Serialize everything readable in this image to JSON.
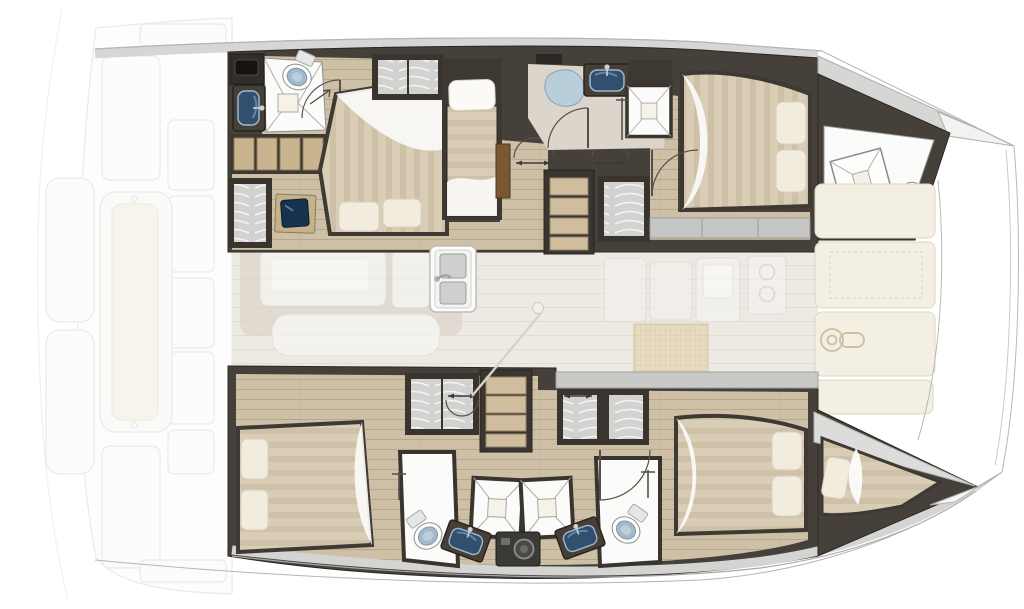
{
  "meta": {
    "title": "Catamaran yacht interior floor plan — top view, bow pointing right",
    "diagram_type": "floor-plan",
    "orientation": {
      "bow": "right",
      "stern": "left"
    }
  },
  "colors": {
    "background": "#ffffff",
    "wall_dark": "#46403a",
    "wall_edge": "#2b2723",
    "deck_band": "#d5d5d3",
    "wood_floor": "#cec0a6",
    "wood_line": "#b8a88b",
    "salon_floor": "#edeae3",
    "bath_floor": "#fbfbf9",
    "bath_floor_warm": "#dbd5cc",
    "mattress": "#d9cdb6",
    "mattress_stripe": "#cec1a7",
    "pillow": "#f2ecdf",
    "blanket": "#fcfbf8",
    "sink_basin": "#31506e",
    "sink_rim": "#9db7ca",
    "toilet_seat": "#a3b9cb",
    "shower_glass": "#b9cedb",
    "locker_fill": "#d2d2d0",
    "locker_wave": "#f4f4f2",
    "stair_tread": "#cfbd9d",
    "ghost_line": "#dddddb",
    "ghost_fill": "#fafaf8",
    "cushion_cream": "#f3ecdf",
    "foredeck_panel": "#f4efe3",
    "rattan": "#e8dabb",
    "washer_body": "#3b3a37",
    "door_wood": "#7a5836",
    "screen_navy": "#16324c"
  },
  "areas": [
    {
      "id": "aft-deck",
      "label": "Aft deck, cockpit seat and swim platforms (faded)"
    },
    {
      "id": "hull-structure",
      "label": "Catamaran hull outline, bow pointing right"
    },
    {
      "id": "port-aft-bathroom",
      "label": "Port aft bathroom with toilet, shower and sink"
    },
    {
      "id": "port-aft-cabin",
      "label": "Port aft cabin with island double bed, desk, shelves and wardrobe"
    },
    {
      "id": "port-single-berth",
      "label": "Port midship single berth"
    },
    {
      "id": "port-companionway",
      "label": "Port companionway stairs with wardrobe and door"
    },
    {
      "id": "port-mid-bathroom",
      "label": "Port midship bathroom with shower pod, shower stall and sink"
    },
    {
      "id": "port-forward-cabin",
      "label": "Port forward cabin with double bed"
    },
    {
      "id": "port-forepeak",
      "label": "Port forepeak with deck hatch and toilet"
    },
    {
      "id": "salon",
      "label": "Bridgedeck salon with table and seating (faded)"
    },
    {
      "id": "galley",
      "label": "Galley with double sink, cabinets, stove and rattan mat"
    },
    {
      "id": "foredeck",
      "label": "Foredeck sun cushions with anchor windlass"
    },
    {
      "id": "starboard-aft-cabin",
      "label": "Starboard aft cabin with double bed"
    },
    {
      "id": "starboard-companionway",
      "label": "Starboard companionway stairs with wardrobes"
    },
    {
      "id": "starboard-bathroom",
      "label": "Starboard shared bathroom: two showers, two sinks, two toilets, washer"
    },
    {
      "id": "starboard-forward-cabin",
      "label": "Starboard forward cabin with double bed"
    },
    {
      "id": "starboard-bow-berth",
      "label": "Starboard bow berth"
    }
  ],
  "fixtures": {
    "double_beds": 4,
    "single_berths": 2,
    "toilets": 4,
    "bathroom_sinks": 4,
    "galley_sinks": 1,
    "shower_stalls": 4,
    "shower_pods": 1,
    "wardrobes": 6,
    "shelf_units": 2,
    "staircases": 2,
    "washing_machines": 1,
    "stove_burners": 2,
    "deck_hatches": 2,
    "windlasses": 1,
    "door_swings": 10
  }
}
